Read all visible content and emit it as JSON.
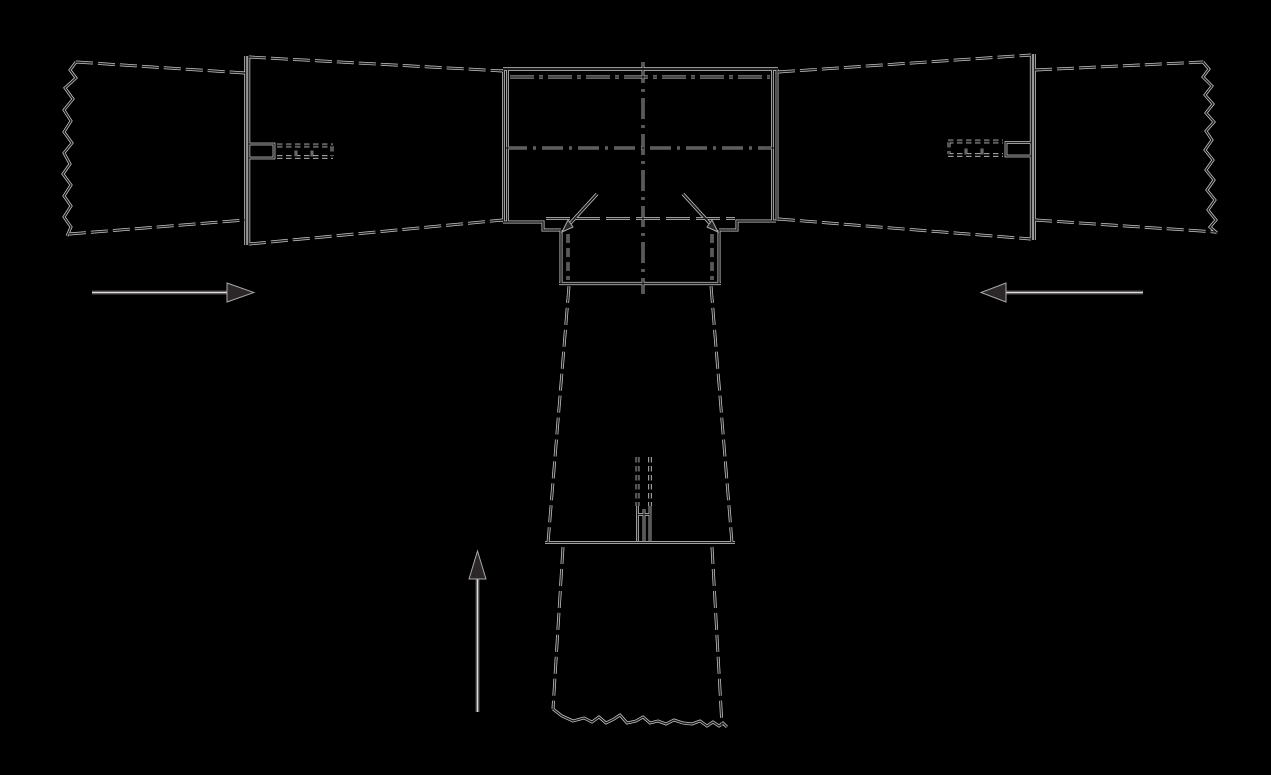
{
  "canvas": {
    "width": 1271,
    "height": 775,
    "viewBox": "0 0 1271 775",
    "background": "#000000"
  },
  "palette": {
    "ink": "#1e1c1d",
    "halo": "#c8c8c8",
    "arrow_fill": "#2b2728",
    "arrow_edge": "#a8a8a8"
  },
  "dash_styles": {
    "member": "17,5",
    "hidden": "9,5",
    "centerline": "21,6,3,6",
    "flange": "24,5,4,5",
    "hidden_long": "24,6",
    "fine": "5.5,3.5"
  },
  "drawing": {
    "shapes": [
      {
        "name": "left-chord-end-break-line",
        "render": "line",
        "style": "solid",
        "w": 1.4,
        "points": "76,62 70,70 76,78 65,88 73,99 64,110 71,121 64,132 72,143 64,153 70,164 63,174 71,185 64,196 71,206 64,217 71,227 67,236"
      },
      {
        "name": "left-chord-end-top-edge",
        "render": "line",
        "style": "member",
        "w": 1.4,
        "points": "76,62 245,73"
      },
      {
        "name": "left-chord-end-bottom-edge",
        "render": "line",
        "style": "member",
        "w": 1.4,
        "points": "69,234 245,220"
      },
      {
        "name": "left-chord-splice-line-outer",
        "render": "line",
        "style": "solid",
        "w": 1.4,
        "points": "245.7,56 245.7,245"
      },
      {
        "name": "left-chord-splice-line-inner",
        "render": "line",
        "style": "solid",
        "w": 1.4,
        "points": "248.8,56 248.8,245"
      },
      {
        "name": "left-chord-top-edge",
        "render": "line",
        "style": "member",
        "w": 1.4,
        "points": "249,57 503,71"
      },
      {
        "name": "left-chord-bottom-edge",
        "render": "line",
        "style": "member",
        "w": 1.4,
        "points": "249,244 503,220"
      },
      {
        "name": "left-splice-connector-plate",
        "render": "line",
        "style": "solid",
        "w": 1.3,
        "points": "249,144 274,144 274,158 249,158"
      },
      {
        "name": "left-splice-hidden-fastener-row-top",
        "render": "line",
        "style": "fine",
        "w": 2.3,
        "points": "277,145.5 333,145.5"
      },
      {
        "name": "left-splice-hidden-fastener-row-bottom",
        "render": "line",
        "style": "fine",
        "w": 2.3,
        "points": "277,157 333,157"
      },
      {
        "name": "left-splice-hidden-fastener-end",
        "render": "line",
        "style": "fine",
        "w": 1.3,
        "points": "332,146 332,156"
      },
      {
        "name": "left-splice-fastener-tick-1",
        "render": "line",
        "style": "solid",
        "w": 1.1,
        "points": "296,150.5 296,156.5"
      },
      {
        "name": "left-splice-fastener-tick-2",
        "render": "line",
        "style": "solid",
        "w": 1.1,
        "points": "312,150.5 312,156.5"
      },
      {
        "name": "gusset-top-edge",
        "render": "line",
        "style": "solid",
        "w": 2.0,
        "points": "503,69 778,69"
      },
      {
        "name": "gusset-left-edge-outer",
        "render": "line",
        "style": "solid",
        "w": 1.4,
        "points": "503.5,69 503.5,222"
      },
      {
        "name": "gusset-left-edge-inner",
        "render": "line",
        "style": "solid",
        "w": 1.4,
        "points": "507.5,69 507.5,222"
      },
      {
        "name": "gusset-right-edge-inner",
        "render": "line",
        "style": "solid",
        "w": 1.4,
        "points": "772.5,69 772.5,221"
      },
      {
        "name": "gusset-right-edge-outer",
        "render": "line",
        "style": "solid",
        "w": 1.4,
        "points": "777,69 777,221"
      },
      {
        "name": "gusset-top-flange-hidden-line",
        "render": "line",
        "style": "flange",
        "w": 1.4,
        "points": "510,77 770,77"
      },
      {
        "name": "horizontal-centerline",
        "render": "line",
        "style": "centerline",
        "w": 1.3,
        "points": "506,148 774,148"
      },
      {
        "name": "vertical-centerline",
        "render": "line",
        "style": "centerline",
        "w": 1.3,
        "points": "643,62 643,294"
      },
      {
        "name": "gusset-bottom-edge-left",
        "render": "line",
        "style": "solid",
        "w": 1.5,
        "points": "503,222 543,222 543,230 561,230"
      },
      {
        "name": "shoe-side-plate-left",
        "render": "line",
        "style": "solid",
        "w": 1.5,
        "points": "561,230 561,283"
      },
      {
        "name": "gusset-bottom-edge-right",
        "render": "line",
        "style": "solid",
        "w": 1.5,
        "points": "776,221 737,221 737,230 719,230"
      },
      {
        "name": "shoe-side-plate-right",
        "render": "line",
        "style": "solid",
        "w": 1.5,
        "points": "719,230 719,283"
      },
      {
        "name": "gusset-bottom-flange-hidden-line",
        "render": "line",
        "style": "hidden_long",
        "w": 1.3,
        "points": "546,218.5 735,218.5"
      },
      {
        "name": "shoe-hidden-edge-left",
        "render": "line",
        "style": "hidden",
        "w": 1.3,
        "points": "568,234 568,280"
      },
      {
        "name": "shoe-hidden-edge-right",
        "render": "line",
        "style": "hidden",
        "w": 1.3,
        "points": "712,234 712,280"
      },
      {
        "name": "gusset-notch-diagonal-left",
        "render": "line",
        "style": "solid",
        "w": 1.8,
        "points": "565,229 597,194"
      },
      {
        "name": "gusset-notch-diagonal-right",
        "render": "line",
        "style": "solid",
        "w": 1.8,
        "points": "715,229 683,194"
      },
      {
        "name": "notch-diagonal-arrowhead-left",
        "render": "fill",
        "points": "562,232 573,227 568,220"
      },
      {
        "name": "notch-diagonal-arrowhead-right",
        "render": "fill",
        "points": "718,232 707,227 712,220"
      },
      {
        "name": "shoe-bottom-edge",
        "render": "line",
        "style": "solid",
        "w": 1.8,
        "points": "559,283.5 721,283.5"
      },
      {
        "name": "post-upper-left-edge",
        "render": "line",
        "style": "member",
        "w": 1.4,
        "points": "569,286 548,543"
      },
      {
        "name": "post-upper-right-edge",
        "render": "line",
        "style": "member",
        "w": 1.4,
        "points": "711,286 732,543"
      },
      {
        "name": "post-hidden-fastener-column-left",
        "render": "line",
        "style": "fine",
        "w": 2.3,
        "points": "637.5,457 637.5,506"
      },
      {
        "name": "post-hidden-fastener-column-right",
        "render": "line",
        "style": "fine",
        "w": 2.3,
        "points": "650,457 650,506"
      },
      {
        "name": "post-slot-plate-line-left",
        "render": "line",
        "style": "solid",
        "w": 1.3,
        "points": "637.5,506 637.5,541"
      },
      {
        "name": "post-slot-plate-line-mid",
        "render": "line",
        "style": "solid",
        "w": 1.3,
        "points": "644,509 644,541"
      },
      {
        "name": "post-slot-plate-line-right",
        "render": "line",
        "style": "solid",
        "w": 1.3,
        "points": "650,506 650,541"
      },
      {
        "name": "post-slot-plate-tick",
        "render": "line",
        "style": "solid",
        "w": 1.2,
        "points": "637,514.5 650,514.5"
      },
      {
        "name": "post-splice-line",
        "render": "line",
        "style": "solid",
        "w": 1.5,
        "points": "545,542.5 735,542.5"
      },
      {
        "name": "post-lower-left-edge",
        "render": "line",
        "style": "member",
        "w": 1.4,
        "points": "563,547 553,709"
      },
      {
        "name": "post-lower-right-edge",
        "render": "line",
        "style": "member",
        "w": 1.4,
        "points": "712,547 722,726"
      },
      {
        "name": "post-end-break-line",
        "render": "line",
        "style": "solid",
        "w": 1.4,
        "points": "553,709 562,716 573,721 584,718 592,722 599,717 606,723 614,719 620,715 627,723 636,721 643,717 650,723 658,721 666,724 674,720 683,723 692,724 700,721 707,726 713,722 719,726 723,723 727,727"
      },
      {
        "name": "right-chord-top-edge",
        "render": "line",
        "style": "member",
        "w": 1.4,
        "points": "778,72 1031,55"
      },
      {
        "name": "right-chord-bottom-edge",
        "render": "line",
        "style": "member",
        "w": 1.4,
        "points": "778,219 1031,239"
      },
      {
        "name": "right-chord-splice-line-inner",
        "render": "line",
        "style": "solid",
        "w": 1.4,
        "points": "1031.3,54 1031.3,240"
      },
      {
        "name": "right-chord-splice-line-outer",
        "render": "line",
        "style": "solid",
        "w": 1.4,
        "points": "1034.5,54 1034.5,240"
      },
      {
        "name": "right-splice-connector-plate",
        "render": "line",
        "style": "solid",
        "w": 1.3,
        "points": "1031,142.5 1006,142.5 1006,156 1031,156"
      },
      {
        "name": "right-splice-hidden-fastener-row-top",
        "render": "line",
        "style": "fine",
        "w": 2.3,
        "points": "948,141.5 1003,141.5"
      },
      {
        "name": "right-splice-hidden-fastener-row-bottom",
        "render": "line",
        "style": "fine",
        "w": 2.3,
        "points": "948,155 1003,155"
      },
      {
        "name": "right-splice-hidden-fastener-end",
        "render": "line",
        "style": "fine",
        "w": 1.3,
        "points": "949,142 949,154"
      },
      {
        "name": "right-splice-fastener-tick-1",
        "render": "line",
        "style": "solid",
        "w": 1.1,
        "points": "966,148.5 966,154.5"
      },
      {
        "name": "right-splice-fastener-tick-2",
        "render": "line",
        "style": "solid",
        "w": 1.1,
        "points": "982,148.5 982,154.5"
      },
      {
        "name": "right-chord-end-top-edge",
        "render": "line",
        "style": "member",
        "w": 1.4,
        "points": "1035,70 1203,62"
      },
      {
        "name": "right-chord-end-bottom-edge",
        "render": "line",
        "style": "member",
        "w": 1.4,
        "points": "1035,220 1216,232"
      },
      {
        "name": "right-chord-end-break-line",
        "render": "line",
        "style": "solid",
        "w": 1.4,
        "points": "1203,62 1209,69 1203,77 1212,86 1205,95 1213,104 1206,113 1214,122 1206,131 1212,140 1205,150 1213,160 1206,170 1214,180 1207,190 1215,200 1208,210 1216,220 1210,227 1217,233"
      },
      {
        "name": "left-force-arrow-shaft",
        "render": "hollow",
        "style": "solid",
        "w": 1.6,
        "points": "92,292.5 229,292.5"
      },
      {
        "name": "left-force-arrow-head",
        "render": "fill",
        "points": "227,283 254,292.5 227,302"
      },
      {
        "name": "right-force-arrow-shaft",
        "render": "hollow",
        "style": "solid",
        "w": 1.6,
        "points": "1005,292.5 1143,292.5"
      },
      {
        "name": "right-force-arrow-head",
        "render": "fill",
        "points": "1006,283 981,292.5 1006,302"
      },
      {
        "name": "bottom-force-arrow-shaft",
        "render": "hollow",
        "style": "solid",
        "w": 1.6,
        "points": "477.5,578 477.5,712"
      },
      {
        "name": "bottom-force-arrow-head",
        "render": "fill",
        "points": "469,579 477.5,551 486,579"
      }
    ]
  }
}
